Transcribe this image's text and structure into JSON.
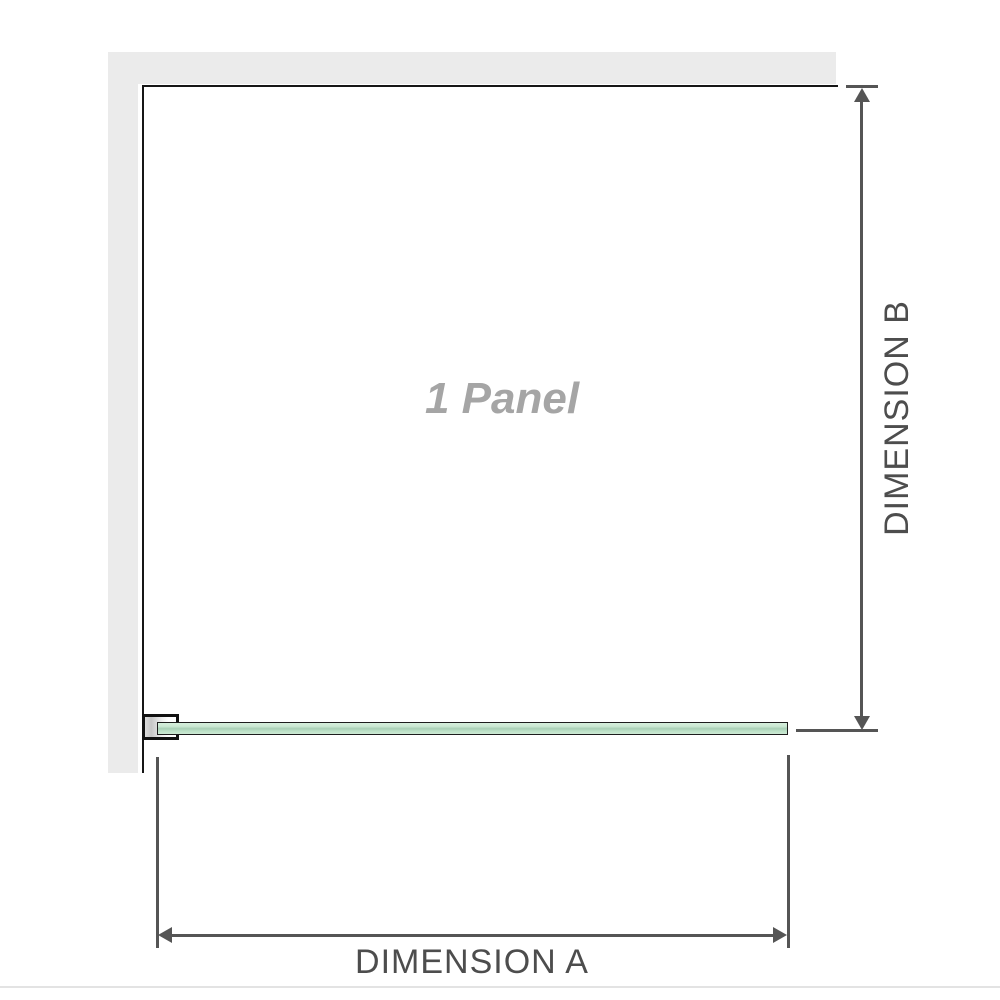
{
  "diagram": {
    "title": "1 Panel shower screen plan diagram",
    "panel_label": "1 Panel",
    "dim_a": {
      "label": "DIMENSION A",
      "orientation": "horizontal"
    },
    "dim_b": {
      "label": "DIMENSION B",
      "orientation": "vertical"
    }
  },
  "icons": [
    {
      "name": "dim-b-arrow-up-icon"
    },
    {
      "name": "dim-b-arrow-down-icon"
    },
    {
      "name": "dim-a-arrow-left-icon"
    },
    {
      "name": "dim-a-arrow-right-icon"
    }
  ],
  "colors": {
    "wall_fill": "#ebebeb",
    "wall_edge": "#161616",
    "glass_fill_light": "#d6efdc",
    "glass_fill_mid": "#a9cfb6",
    "glass_border": "#1d1d1d",
    "dimension_line": "#555555",
    "dimension_text": "#4d4d4d",
    "panel_label_text": "#a5a5a5",
    "separator": "#e3e3e3"
  }
}
